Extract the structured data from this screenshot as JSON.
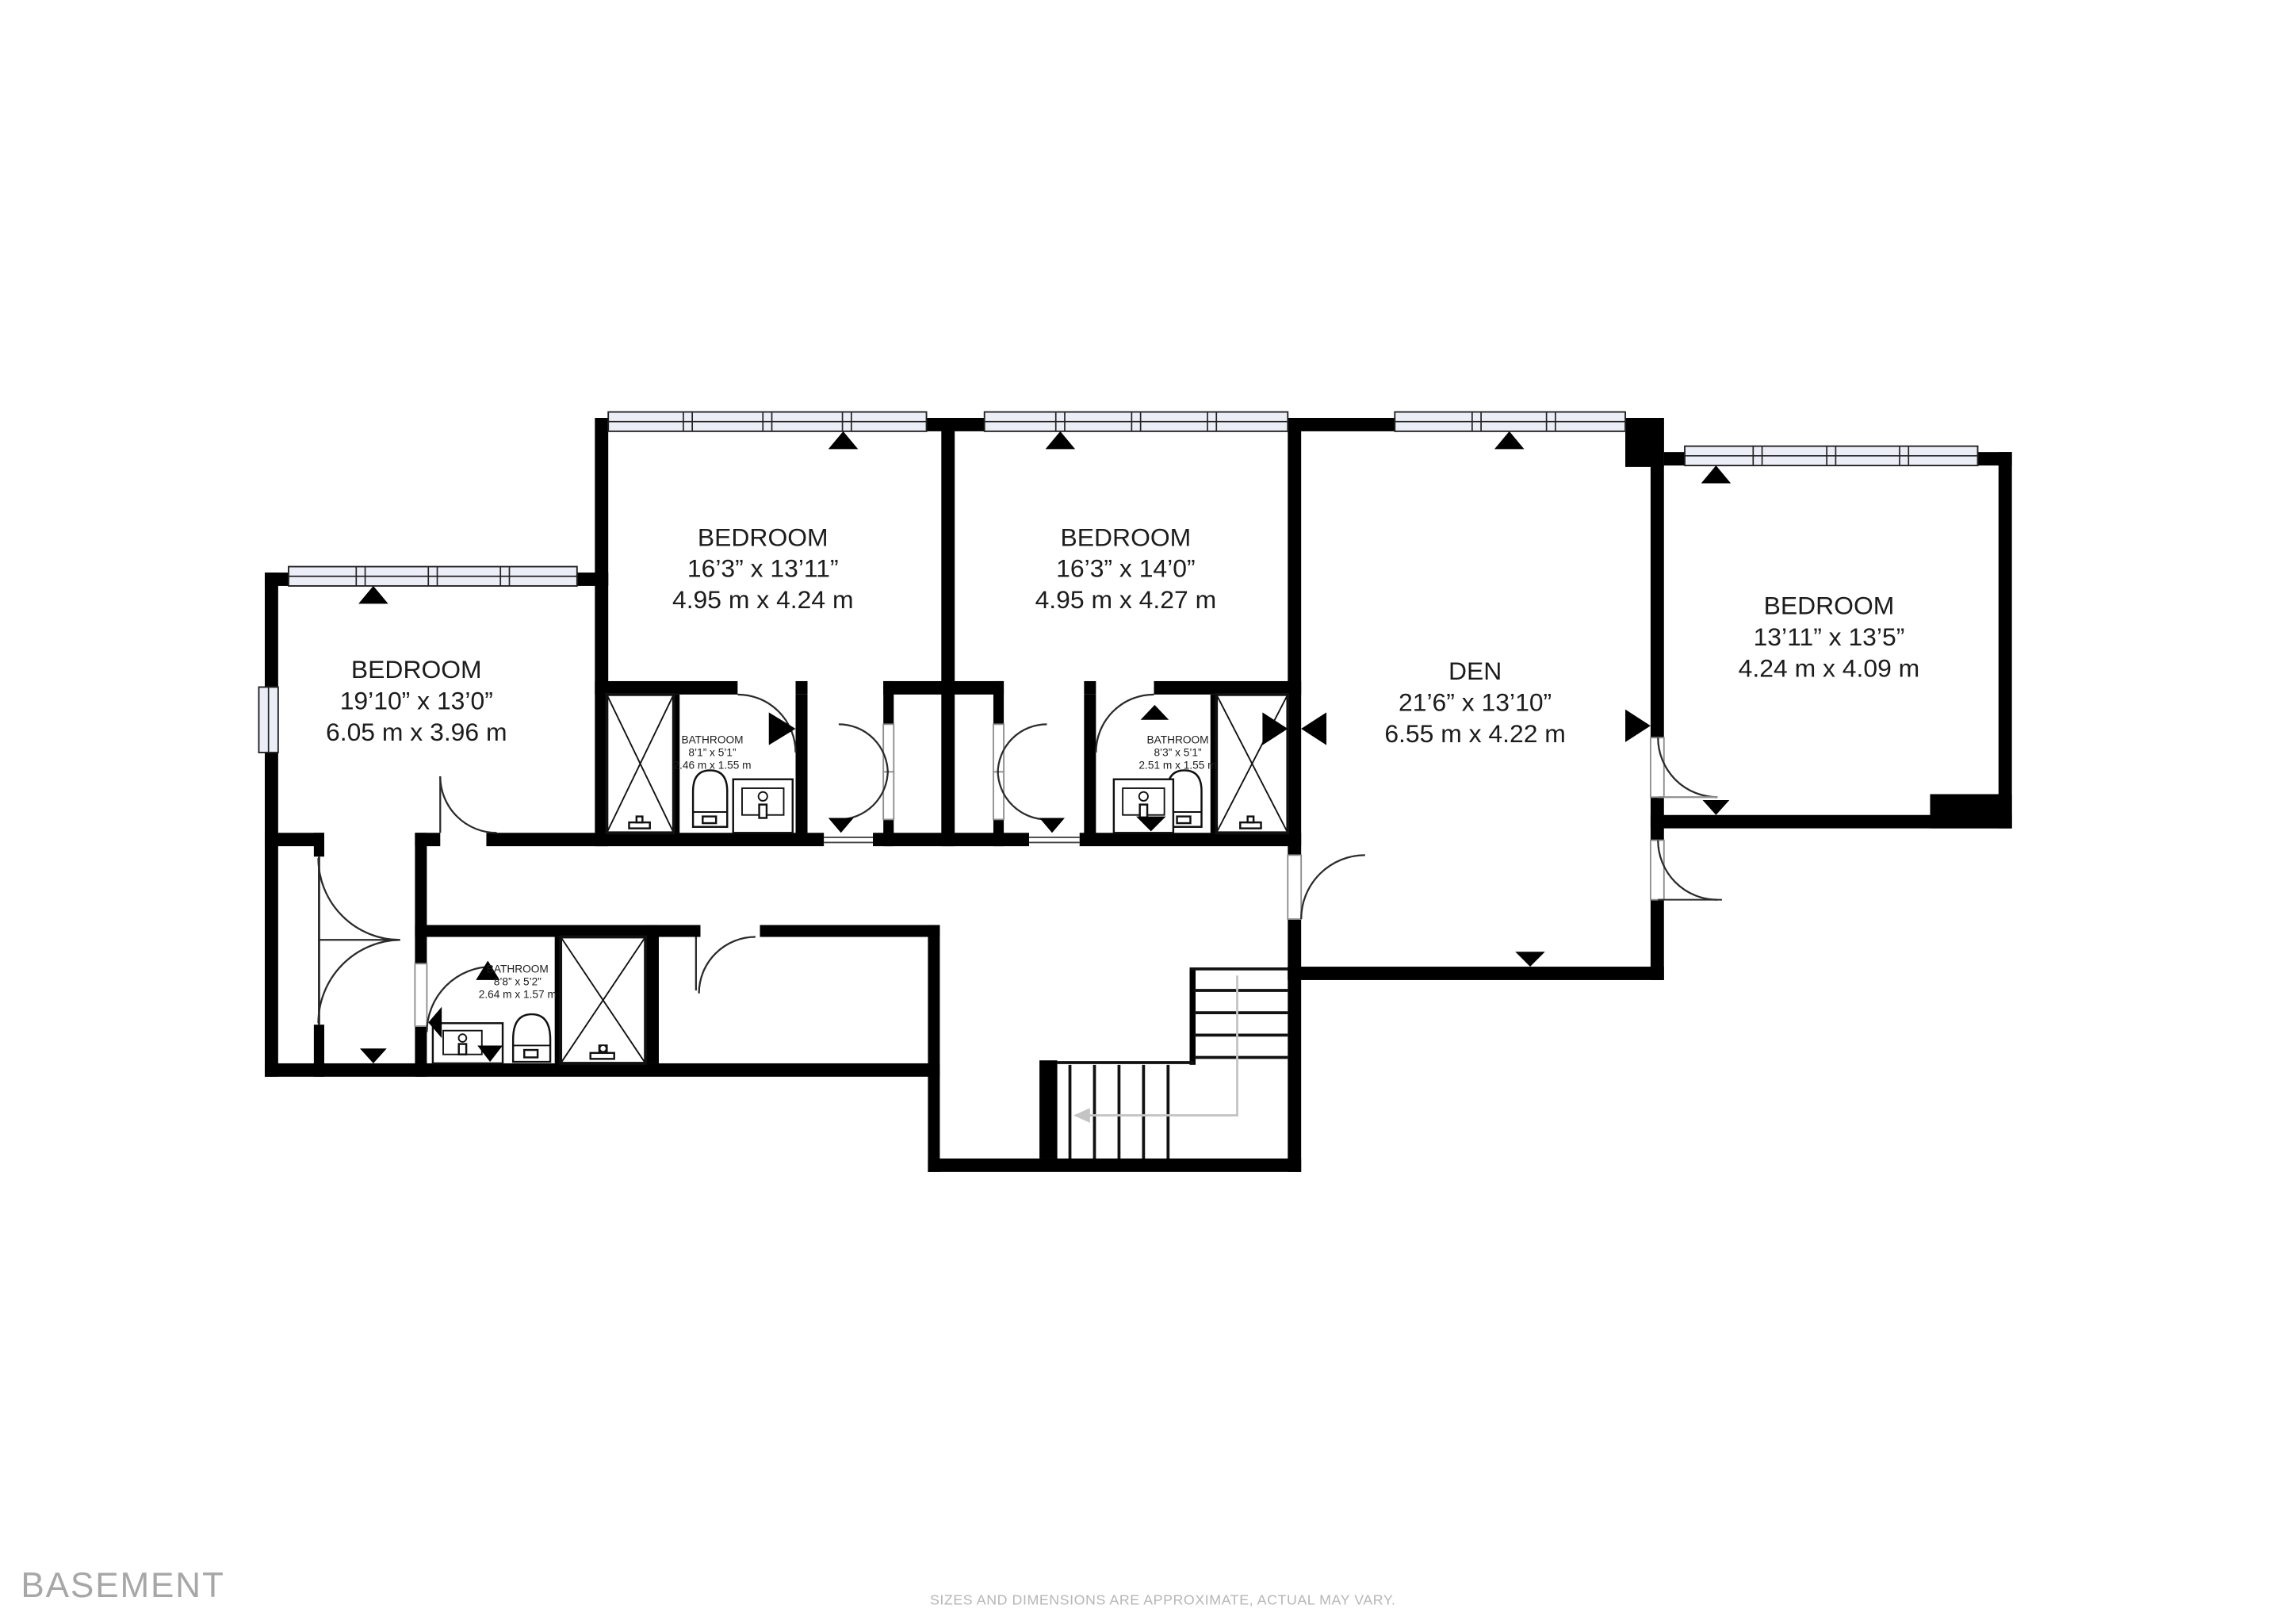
{
  "meta": {
    "floor_label": "BASEMENT",
    "disclaimer": "SIZES AND DIMENSIONS ARE APPROXIMATE, ACTUAL MAY VARY."
  },
  "colors": {
    "wall": "#000000",
    "window_fill": "#eceef7",
    "label": "#1c1c1c",
    "muted": "#a7a7a7",
    "disclaimer": "#b6b6b6",
    "guide": "#c4c4c4"
  },
  "rooms": [
    {
      "id": "bedroom-1",
      "name": "BEDROOM",
      "imperial": "19’10” x 13’0”",
      "metric": "6.05 m x 3.96 m"
    },
    {
      "id": "bedroom-2",
      "name": "BEDROOM",
      "imperial": "16’3” x 13’11”",
      "metric": "4.95 m x 4.24 m"
    },
    {
      "id": "bedroom-3",
      "name": "BEDROOM",
      "imperial": "16’3” x 14’0”",
      "metric": "4.95 m x 4.27 m"
    },
    {
      "id": "den",
      "name": "DEN",
      "imperial": "21’6” x 13’10”",
      "metric": "6.55 m x 4.22 m"
    },
    {
      "id": "bedroom-4",
      "name": "BEDROOM",
      "imperial": "13’11” x 13’5”",
      "metric": "4.24 m x 4.09 m"
    }
  ],
  "bathrooms": [
    {
      "id": "bathroom-1",
      "name": "BATHROOM",
      "imperial": "8’1” x 5’1”",
      "metric": "2.46 m x 1.55 m"
    },
    {
      "id": "bathroom-2",
      "name": "BATHROOM",
      "imperial": "8’3” x 5’1”",
      "metric": "2.51 m x 1.55 m"
    },
    {
      "id": "bathroom-3",
      "name": "BATHROOM",
      "imperial": "8’8” x 5’2”",
      "metric": "2.64 m x 1.57 m"
    }
  ]
}
